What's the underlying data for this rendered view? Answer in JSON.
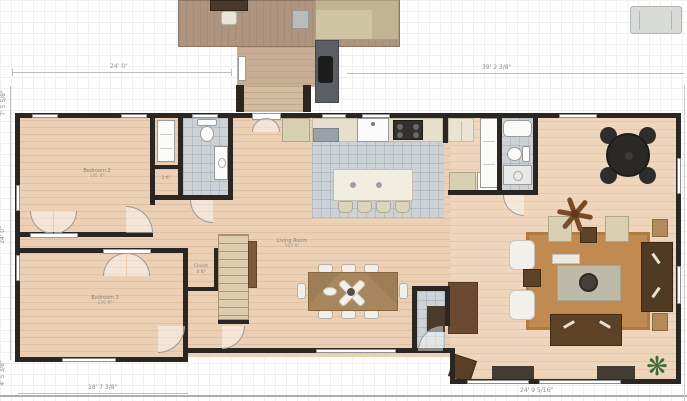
{
  "dimensions": {
    "top_left": "24' 0\"",
    "top_right": "39' 2 3/8\"",
    "left_upper": "7' 5 5/8\"",
    "left_middle": "24' 0\"",
    "left_lower": "4' 5 3/8\"",
    "bottom_left": "18' 7 3/8\"",
    "bottom_right": "24' 9 5/16\""
  },
  "rooms": {
    "bedroom2": {
      "name": "Bedroom 2",
      "area": "145 ft²"
    },
    "bedroom3": {
      "name": "Bedroom 3",
      "area": "176 ft²"
    },
    "living_room": {
      "name": "Living Room",
      "area": "507 ft²"
    },
    "closet": {
      "name": "Closet",
      "area": "4 ft²"
    },
    "linen_closet": {
      "area": "3 ft²"
    }
  },
  "palette": {
    "wall": "#2c2622",
    "wood_floor": "#ebd0b6",
    "tile_floor": "#cdd2d6",
    "deck": "#af9480",
    "rug": "#c08a50",
    "dark_furniture": "#5e4227",
    "dimension_text": "#8c8c8c"
  }
}
